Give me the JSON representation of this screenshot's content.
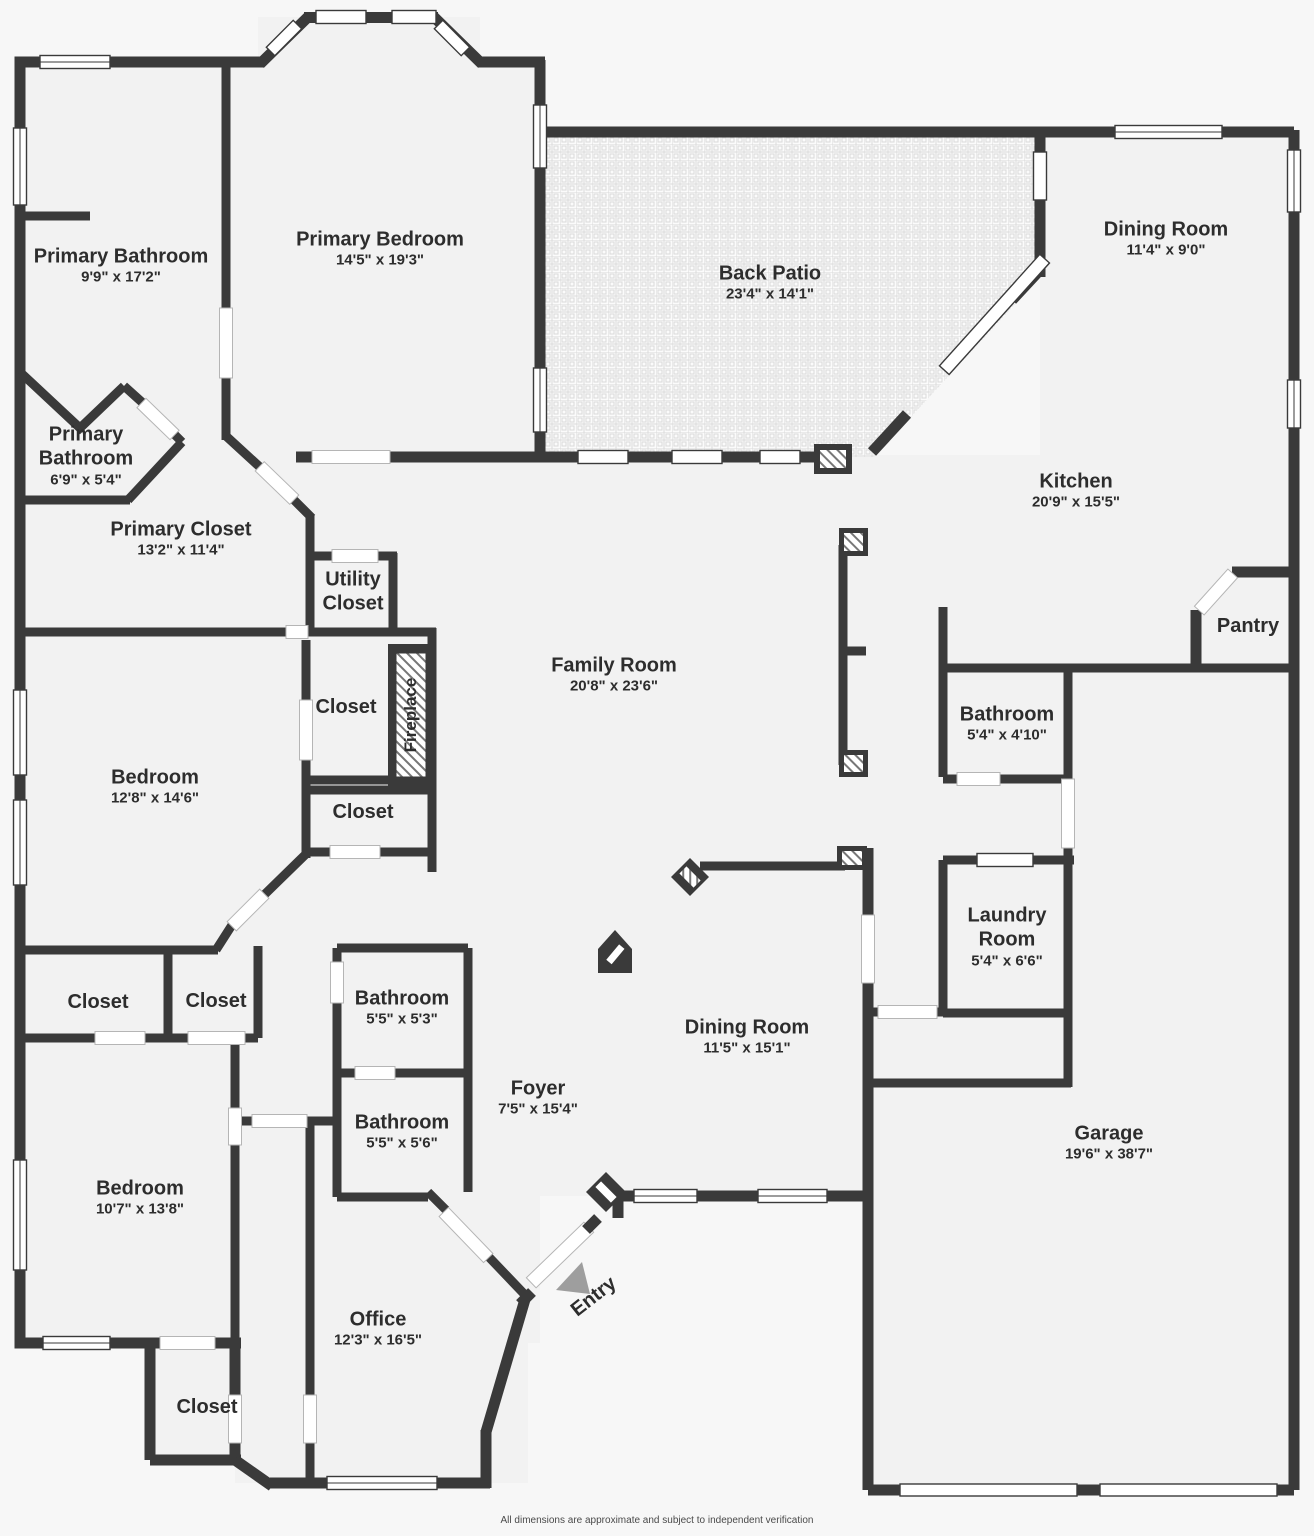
{
  "colors": {
    "wall": "#3a3a3a",
    "room_fill": "#f2f2f2",
    "background": "#f7f7f7",
    "text": "#2d2d2d",
    "entry_arrow": "#9e9e9e",
    "hatch": "#777777",
    "tile_line": "#d9d9d9"
  },
  "rooms": [
    {
      "name": "Primary Bathroom",
      "dims": "9'9\" x 17'2\""
    },
    {
      "name": "Primary Bedroom",
      "dims": "14'5\" x 19'3\""
    },
    {
      "name": "Back Patio",
      "dims": "23'4\" x 14'1\""
    },
    {
      "name": "Dining Room",
      "dims": "11'4\" x 9'0\""
    },
    {
      "name": "Primary Bathroom",
      "dims": "6'9\" x 5'4\""
    },
    {
      "name": "Primary Closet",
      "dims": "13'2\" x 11'4\""
    },
    {
      "name": "Utility Closet",
      "dims": ""
    },
    {
      "name": "Kitchen",
      "dims": "20'9\" x 15'5\""
    },
    {
      "name": "Pantry",
      "dims": ""
    },
    {
      "name": "Family Room",
      "dims": "20'8\" x 23'6\""
    },
    {
      "name": "Closet",
      "dims": ""
    },
    {
      "name": "Bedroom",
      "dims": "12'8\" x 14'6\""
    },
    {
      "name": "Closet",
      "dims": ""
    },
    {
      "name": "Bathroom",
      "dims": "5'4\" x 4'10\""
    },
    {
      "name": "Laundry Room",
      "dims": "5'4\" x 6'6\""
    },
    {
      "name": "Closet",
      "dims": ""
    },
    {
      "name": "Closet",
      "dims": ""
    },
    {
      "name": "Bathroom",
      "dims": "5'5\" x 5'3\""
    },
    {
      "name": "Bathroom",
      "dims": "5'5\" x 5'6\""
    },
    {
      "name": "Foyer",
      "dims": "7'5\" x 15'4\""
    },
    {
      "name": "Dining Room",
      "dims": "11'5\" x 15'1\""
    },
    {
      "name": "Bedroom",
      "dims": "10'7\" x 13'8\""
    },
    {
      "name": "Garage",
      "dims": "19'6\" x 38'7\""
    },
    {
      "name": "Office",
      "dims": "12'3\" x 16'5\""
    },
    {
      "name": "Closet",
      "dims": ""
    }
  ],
  "annotations": {
    "fireplace": "Fireplace",
    "entry": "Entry"
  },
  "footer": {
    "text": "All dimensions are approximate and subject to independent verification"
  }
}
